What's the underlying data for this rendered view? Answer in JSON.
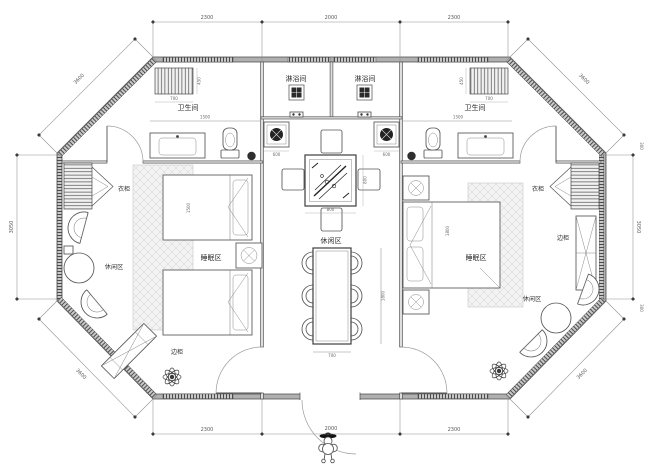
{
  "plan": {
    "labels": {
      "shower_left": "淋浴间",
      "shower_right": "淋浴间",
      "bath_left": "卫生间",
      "bath_right": "卫生间",
      "wardrobe_left": "衣柜",
      "wardrobe_right": "衣柜",
      "cabinet_left": "边柜",
      "cabinet_right": "边柜",
      "sleep_left": "睡眠区",
      "sleep_right": "睡眠区",
      "leisure_left": "休闲区",
      "leisure_center": "休闲区",
      "leisure_right": "休闲区"
    },
    "dims": {
      "top": [
        "2300",
        "2000",
        "2300"
      ],
      "bottom": [
        "2300",
        "2000",
        "2300"
      ],
      "left_side": "3050",
      "right_side": "3050",
      "diag_top_left": "3600",
      "diag_top_right": "3600",
      "diag_bottom_left": "3600",
      "diag_bottom_right": "3600",
      "wall_offset_top_right": "300",
      "wall_offset_bottom_right": "300",
      "bath_width_left": "1500",
      "bath_width_right": "1500",
      "bath_shelf_left": "700",
      "bath_shelf_right": "700",
      "bath_shelf_depth": "450",
      "basin_left": "600",
      "basin_right": "600",
      "tea_table_w": "800",
      "tea_table_h": "800",
      "dining_l": "1800",
      "dining_w": "700",
      "bed_single": "1500",
      "bed_double": "1800"
    },
    "colors": {
      "wall_fill": "#b0b0b0",
      "line": "#4b4b4b",
      "dim_line": "#8f8f8f",
      "carpet_hatch": "#d0d0d0"
    }
  }
}
